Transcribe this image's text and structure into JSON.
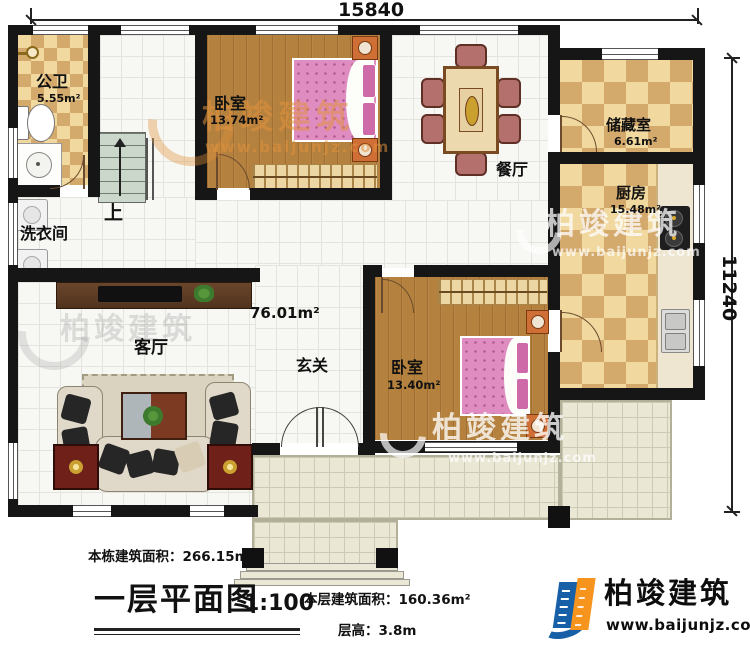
{
  "dimensions": {
    "top": "15840",
    "right": "11240"
  },
  "rooms": {
    "bathroom": {
      "name": "公卫",
      "area": "5.55m²"
    },
    "laundry": {
      "name": "洗衣间"
    },
    "stairs": {
      "label": "上"
    },
    "bedroom1": {
      "name": "卧室",
      "area": "13.74m²"
    },
    "dining": {
      "name": "餐厅"
    },
    "storage": {
      "name": "储藏室",
      "area": "6.61m²"
    },
    "kitchen": {
      "name": "厨房",
      "area": "15.48m²"
    },
    "living": {
      "name": "客厅"
    },
    "foyer": {
      "name": "玄关"
    },
    "bedroom2": {
      "name": "卧室",
      "area": "13.40m²"
    },
    "hall": {
      "area": "76.01m²"
    }
  },
  "annotations": {
    "building_total": "本栋建筑面积：266.15m²",
    "floor_title": "一层平面图",
    "scale": "1:100",
    "floor_area": "本层建筑面积：160.36m²",
    "floor_height": "层高：3.8m"
  },
  "brand": {
    "name": "柏竣建筑",
    "website": "www.baijunjz.com"
  },
  "watermark": {
    "name": "柏竣建筑",
    "website": "www.baijunjz.com"
  },
  "colors": {
    "wall": "#161616",
    "checker_light": "#f0d89e",
    "checker_dark": "#d4a96c",
    "wood": "#b5813e",
    "tile": "#f7f7f4",
    "patio": "#eae7d5",
    "bed_pink": "#df8cc0",
    "logo_blue": "#1760a8",
    "logo_orange": "#f7941d",
    "watermark_orange": "#e0923c"
  }
}
